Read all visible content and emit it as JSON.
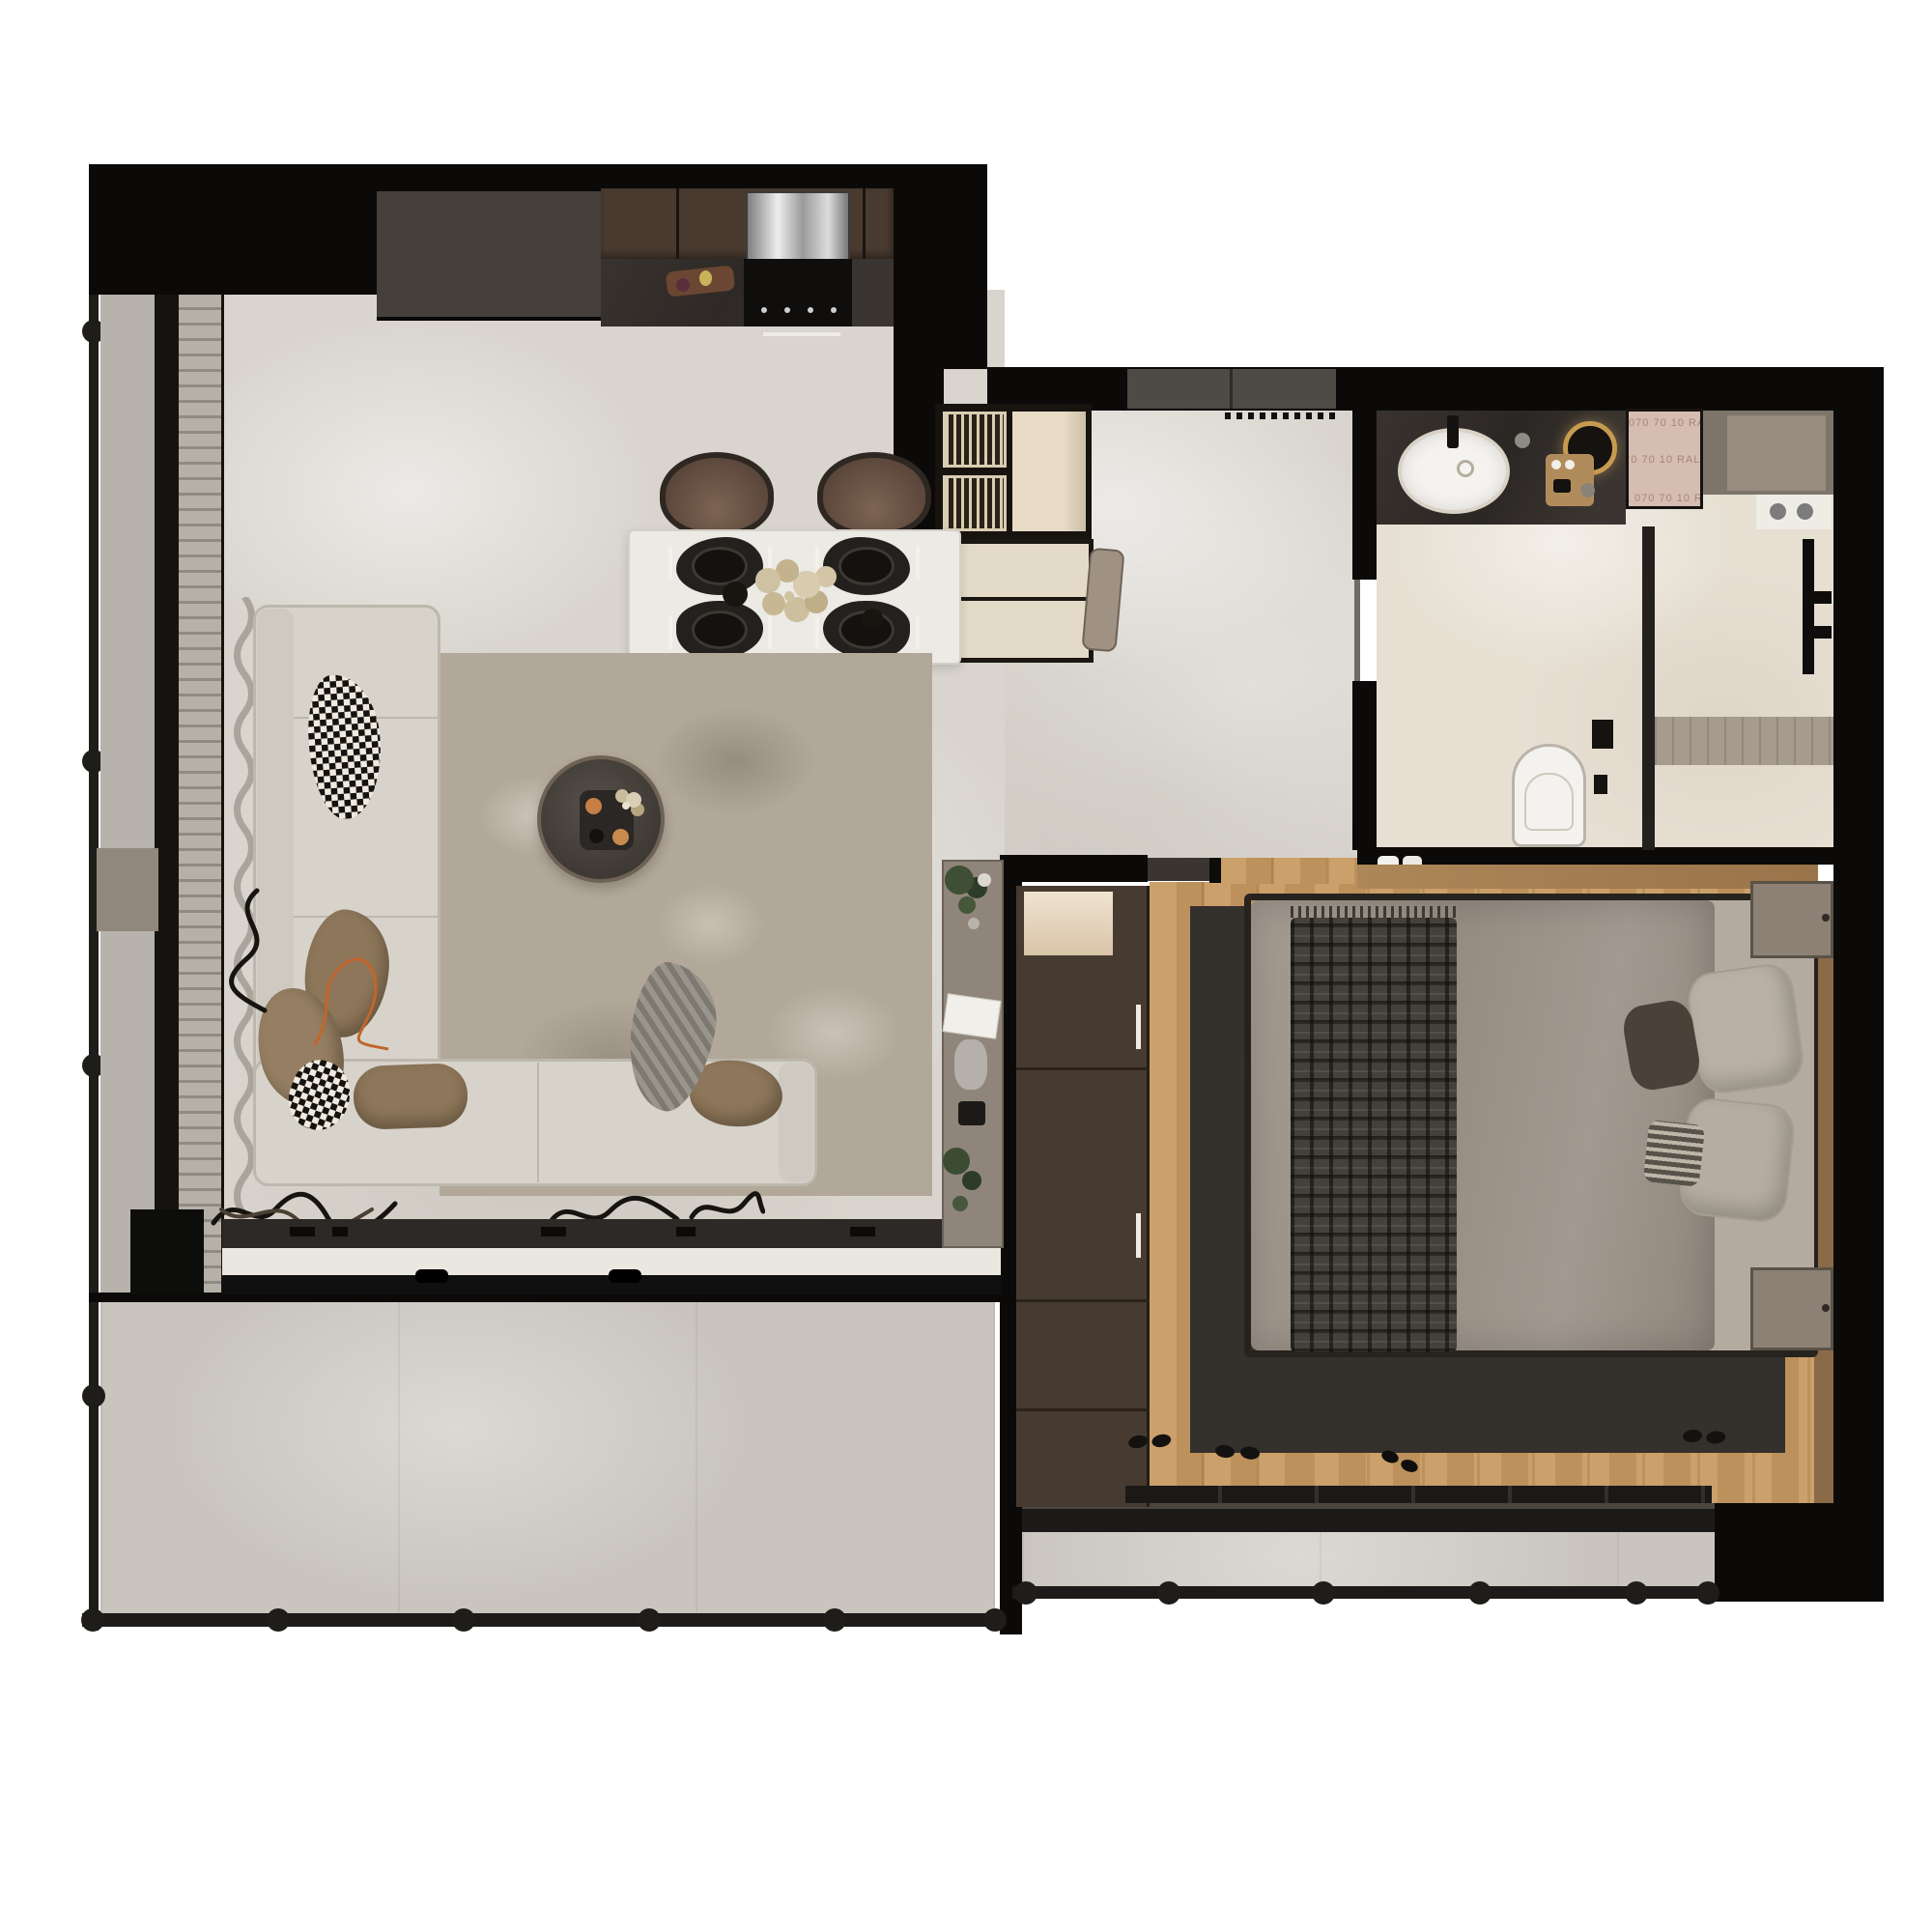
{
  "scene": {
    "type": "apartment-floor-plan-render",
    "view": "top-down-3d",
    "background": "#ffffff"
  },
  "labels": {
    "ral_swatch": "RAL 070 70 10"
  },
  "palette": {
    "wall": "#0b0a09",
    "living_floor": "#d9d5ce",
    "bathroom_floor": "#e6dfd2",
    "terrace_floor": "#c9c5be",
    "wood_floor": "#c89a61",
    "living_rug": "#b2a899",
    "bedroom_rug": "#34302c",
    "sofa": "#d7d3cb",
    "kitchen_cabinet": "#4a3b30",
    "counter_marble": "#38322f",
    "chair_leather": "#6e584a",
    "duvet": "#9c938a",
    "wardrobe": "#473b31",
    "sideboard": "#8f857a",
    "ral_panel": "#d6bdb2",
    "mirror_ring_gold": "#c79b4f",
    "railing": "#1d1b19"
  },
  "rooms": {
    "kitchen": {
      "items": [
        "upper-cabinets-brown",
        "tall-cabinet-charcoal",
        "range-hood-steel",
        "cooktop-black",
        "counter-dark-marble",
        "fruit-decor"
      ]
    },
    "dining": {
      "items": [
        "dining-table-white",
        "chairs-brown-x4",
        "placemats-black-x4",
        "centerpiece-flowers",
        "serving-bowls"
      ]
    },
    "living_room": {
      "items": [
        "sectional-sofa-L",
        "houndstooth-pillows",
        "tan-pillows",
        "area-rug",
        "round-coffee-table",
        "tray-with-cups",
        "media-console",
        "speaker-box",
        "sheer-curtains",
        "dried-branch-decor",
        "sideboard-with-plants"
      ]
    },
    "entry": {
      "items": [
        "entry-door",
        "doormat-dots",
        "slatted-shoe-cabinet",
        "open-shelf-beige",
        "storage-bench",
        "bag"
      ]
    },
    "bathroom": {
      "items": [
        "vanity-dark-marble",
        "oval-sink-white",
        "black-faucet",
        "round-mirror-backlit",
        "wood-tray-cosmetics",
        "ral-swatch-panel",
        "utility-niche",
        "flush-plate-two-buttons",
        "glass-partition",
        "shower-set-black",
        "shower-tray",
        "wall-hung-toilet",
        "toilet-accessories",
        "towel-rolls"
      ]
    },
    "bedroom": {
      "items": [
        "wardrobe-4-door",
        "lighted-niche",
        "sliding-door",
        "double-bed",
        "duvet-gray",
        "plaid-throw",
        "pillows",
        "striped-pillow",
        "nightstands-x2",
        "headboard-wood-ledge",
        "dark-rug",
        "tv-bench",
        "slippers"
      ]
    },
    "terrace": {
      "items": [
        "stone-tile-floor",
        "railing-with-posts"
      ]
    },
    "balcony": {
      "items": [
        "tile-floor",
        "railing-with-posts"
      ]
    }
  }
}
